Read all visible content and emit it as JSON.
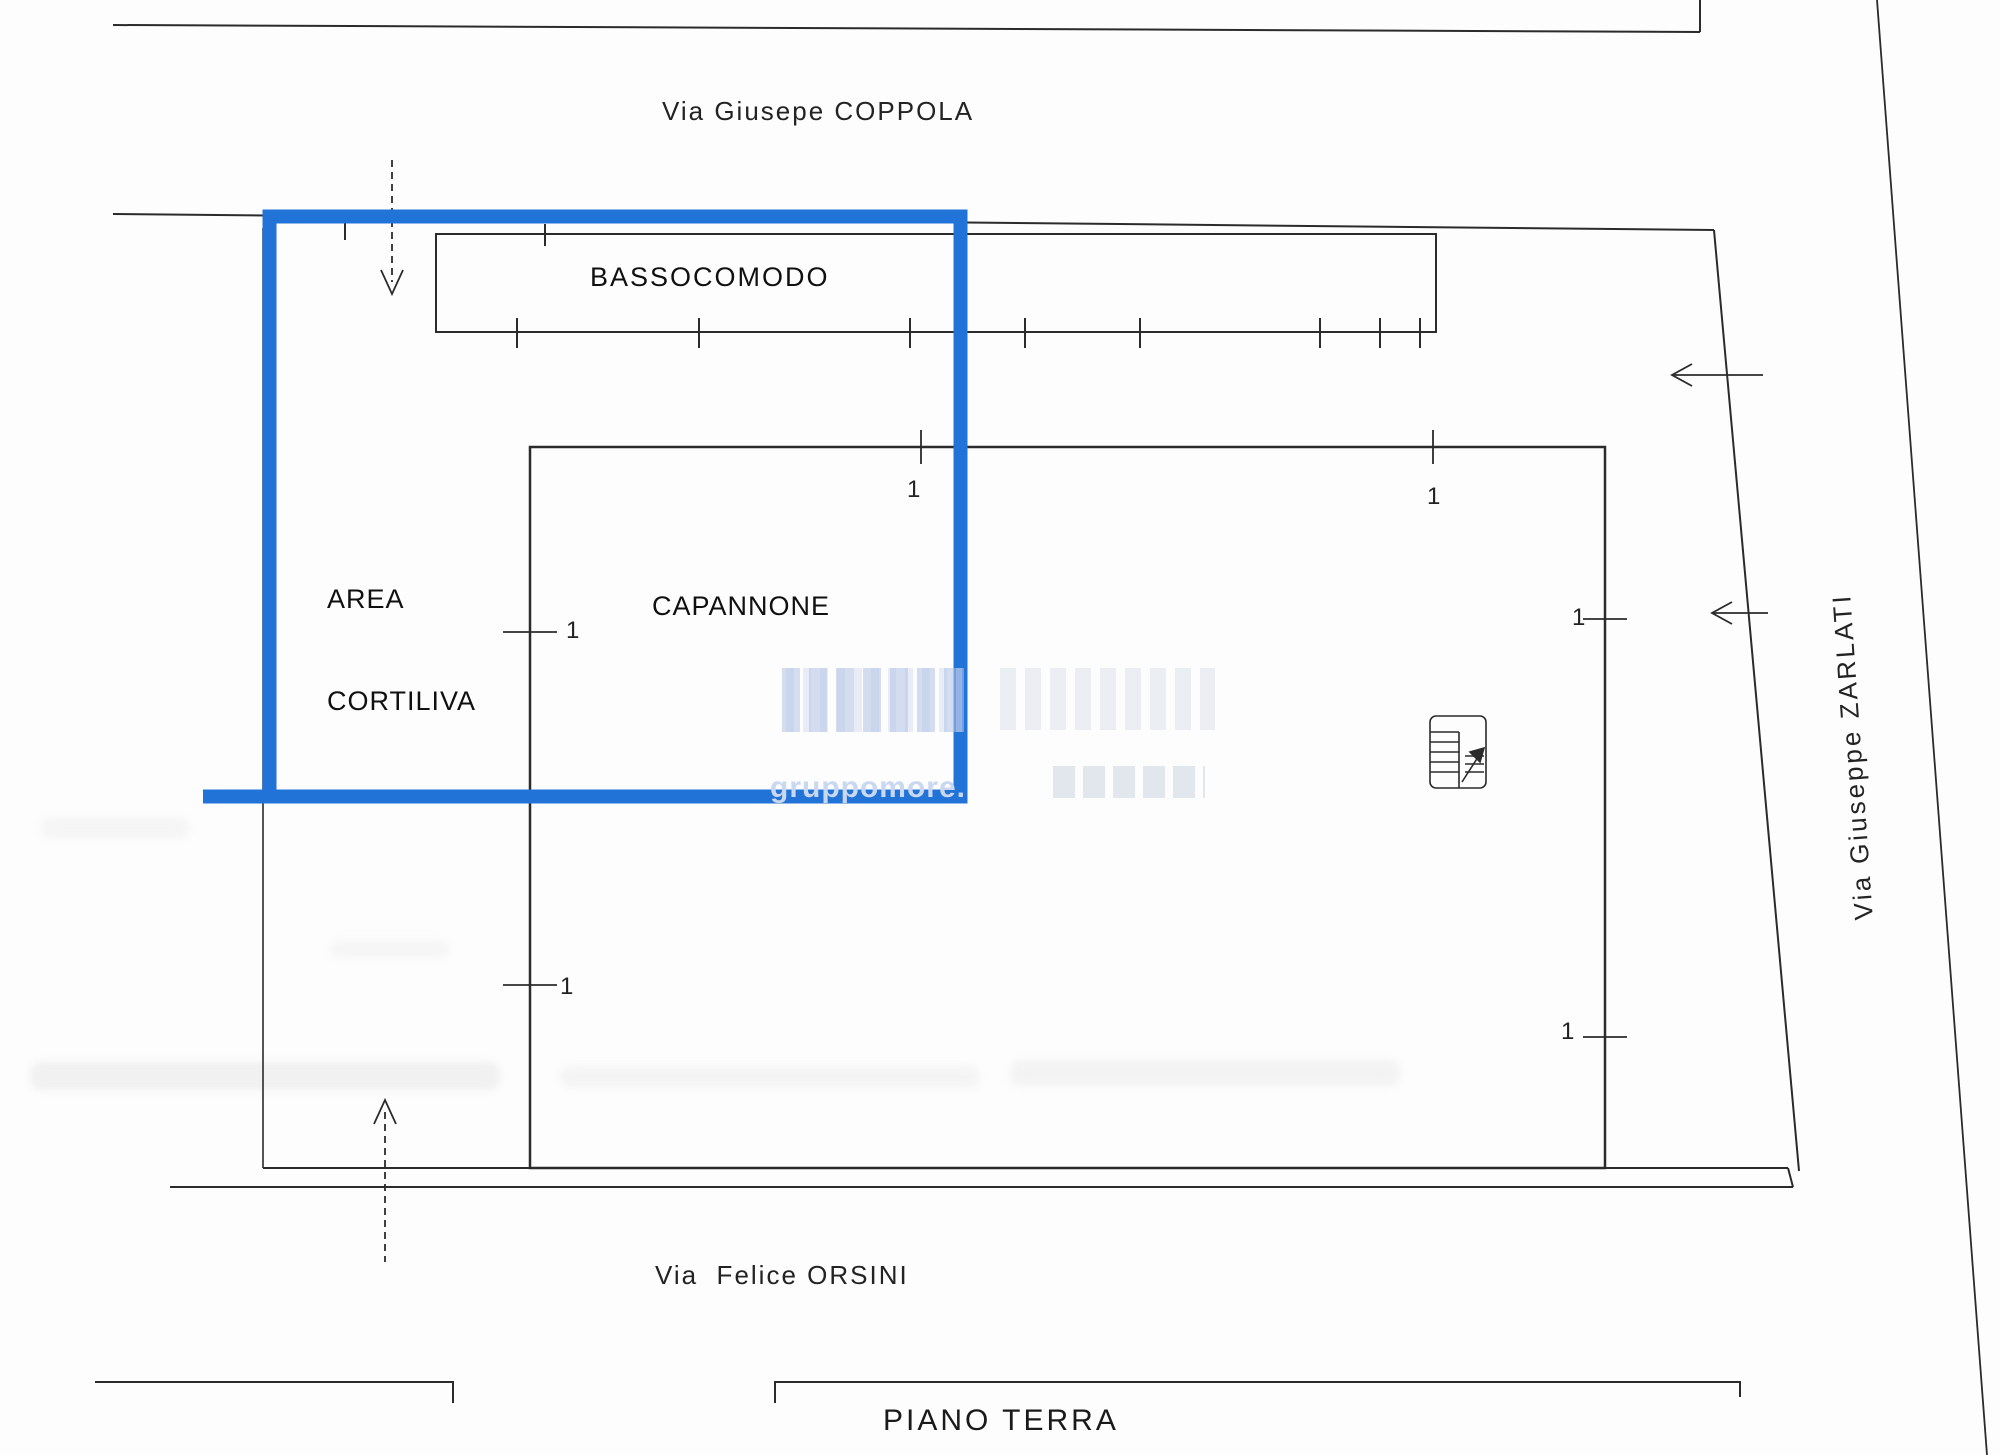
{
  "plan_title": "PIANO TERRA",
  "streets": {
    "top": "Via Giusepe COPPOLA",
    "bottom": "Via  Felice ORSINI",
    "right": "Via Giuseppe ZARLATI"
  },
  "areas": {
    "outbuilding": "BASSOCOMODO",
    "courtyard_line1": "AREA",
    "courtyard_line2": "CORTILIVA",
    "warehouse": "CAPANNONE"
  },
  "dimensions": {
    "labels": [
      "1",
      "1",
      "1",
      "1",
      "1",
      "1"
    ]
  },
  "watermark": {
    "text": "gruppomore.i"
  },
  "colors": {
    "highlight_blue": "#2273d8",
    "ink_black": "#2b2b2b",
    "watermark_light": "#c9d7f0"
  }
}
